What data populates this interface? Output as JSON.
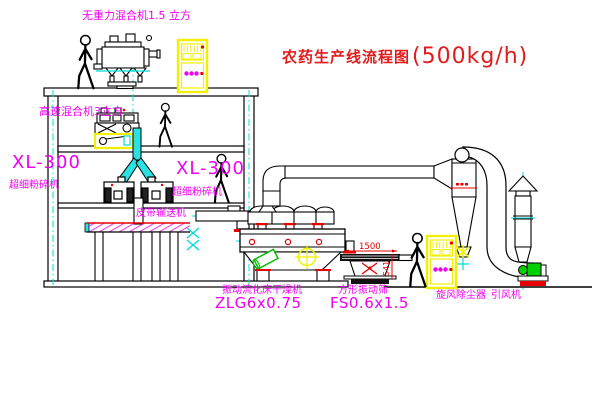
{
  "diagram": {
    "title": "农药生产线流程图",
    "title_capacity": "(500kg/h)"
  },
  "labels": {
    "gravity_mixer": "无重力混合机1.5 立方",
    "high_speed_mixer": "高速混合机3立方",
    "mill_left_model": "XL-300",
    "mill_left_name": "超细粉碎机",
    "mill_center_model": "XL-300",
    "mill_center_name": "超细粉碎机",
    "belt_conveyor": "皮带输送机",
    "dryer_name": "振动流化床干燥机",
    "dryer_model": "ZLG6x0.75",
    "sieve_name": "方形振动筛",
    "sieve_model": "FS0.6x1.5",
    "cyclone": "旋风除尘器",
    "fan": "引风机"
  },
  "dimensions": {
    "sieve_length": "1500",
    "sieve_height": "541"
  },
  "colors": {
    "background": "#ffffff",
    "line": "#000000",
    "centerline": "#00dcdc",
    "label_magenta": "#f000f0",
    "title_red": "#e31b1b",
    "dimension_red": "#e80000",
    "cabinet_yellow": "#f0f000",
    "machine_green": "#00c000"
  }
}
